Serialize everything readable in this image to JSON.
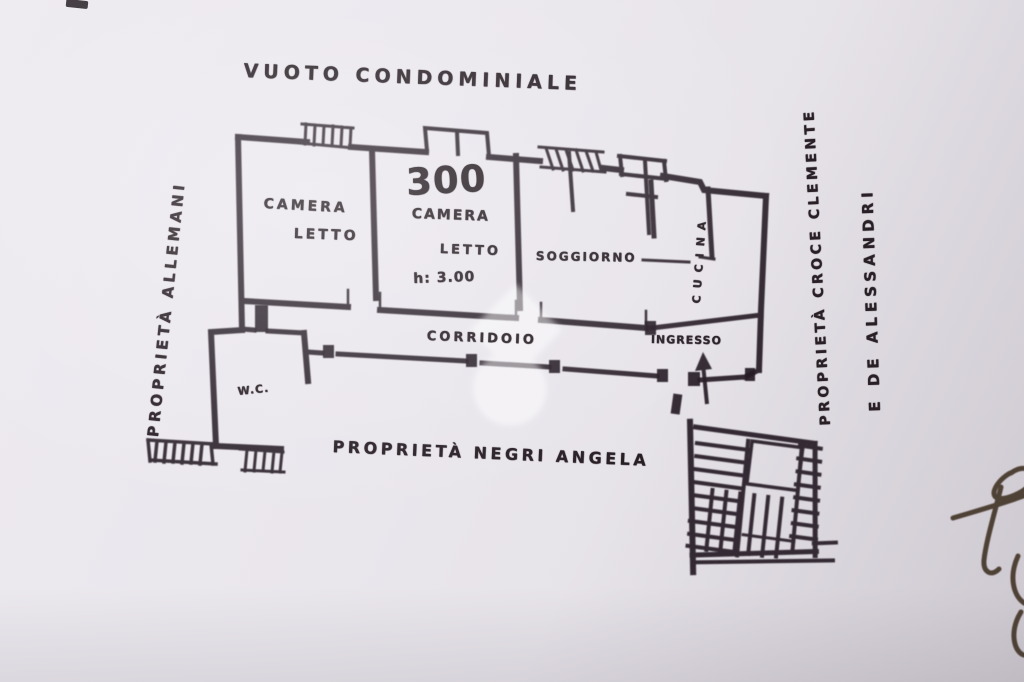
{
  "boundary_labels": {
    "top": "VUOTO CONDOMINIALE",
    "left": "PROPRIETÀ ALLEMANI",
    "right_line1": "PROPRIETÀ CROCE CLEMENTE",
    "right_line2": "E DE ALESSANDRI",
    "bottom": "PROPRIETÀ NEGRI ANGELA"
  },
  "rooms": {
    "bedroom1": {
      "line1": "CAMERA",
      "line2": "LETTO"
    },
    "bedroom2": {
      "area": "300",
      "line1": "CAMERA",
      "line2": "LETTO",
      "height": "h: 3.00"
    },
    "living_room": "SOGGIORNO",
    "corridor": "CORRIDOIO",
    "kitchen": "CUCINA",
    "entry": "INGRESSO",
    "wc": "W.C."
  },
  "icons": {
    "watermark": "home-pin-watermark",
    "entrance_arrow": "entrance-arrow-up",
    "staircase": "staircase-sketch",
    "signature": "handwritten-signature-fragment"
  },
  "colors": {
    "paper": "#e9e6ec",
    "ink": "#281f25",
    "signature_ink": "#3d2e1f",
    "watermark": "#ffffff"
  }
}
